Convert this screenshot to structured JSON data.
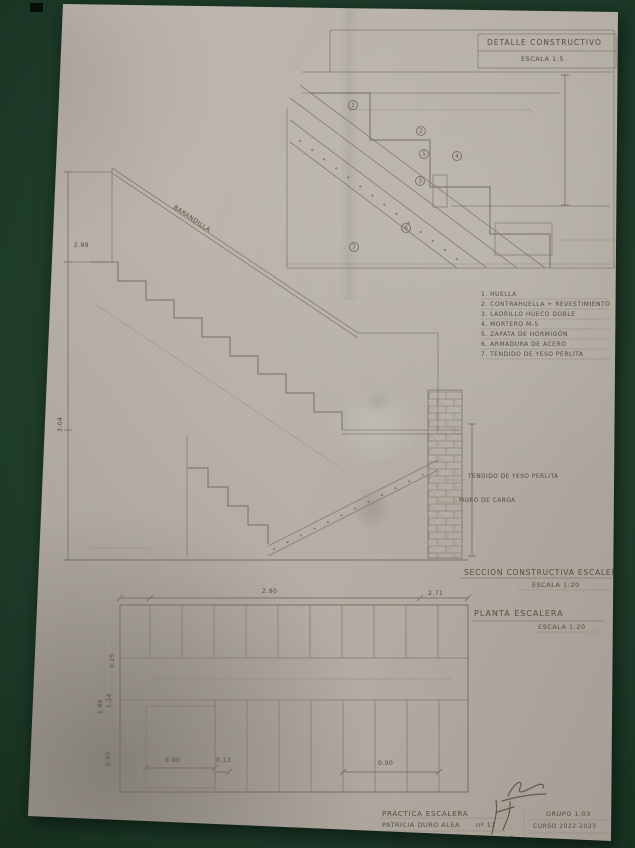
{
  "colors": {
    "background_green": "#1e3b2a",
    "paper": "#b6b0a7",
    "pencil": "#756d61"
  },
  "detail": {
    "title": "DETALLE CONSTRUCTIVO",
    "scale": "ESCALA 1:5",
    "callouts": [
      "1",
      "2",
      "3",
      "4",
      "5",
      "6",
      "7"
    ]
  },
  "legend": {
    "items": [
      "1. HUELLA",
      "2. CONTRAHUELLA + REVESTIMIENTO",
      "3. LADRILLO HUECO DOBLE",
      "4. MORTERO M-5",
      "5. ZAPATA DE HORMIGÓN",
      "6. ARMADURA DE ACERO",
      "7. TENDIDO DE YESO PERLITA"
    ]
  },
  "section": {
    "title": "SECCIÓN CONSTRUCTIVA ESCALERA",
    "scale": "ESCALA 1:20",
    "labels": {
      "barandilla": "BARANDILLA",
      "yeso": "TENDIDO DE YESO PERLITA",
      "muro": "MURO DE CARGA"
    },
    "dims": {
      "total_height": "3.04",
      "level": "2.89"
    }
  },
  "plan": {
    "title": "PLANTA ESCALERA",
    "scale": "ESCALA 1:20",
    "dims": {
      "top_width": "2.90",
      "top_right": "2.71",
      "bottom_left": "0.90",
      "bottom_mid": "0.13",
      "bottom_right": "0.90",
      "left_a": "1.88",
      "left_b": "1.24",
      "left_c": "0.95",
      "left_d": "0.25"
    }
  },
  "titleblock": {
    "project": "PRÁCTICA ESCALERA",
    "author": "PATRICIA DURO ALEA",
    "sheet": "nº 11",
    "group": "GRUPO 1.03",
    "course": "CURSO 2022-2023"
  }
}
